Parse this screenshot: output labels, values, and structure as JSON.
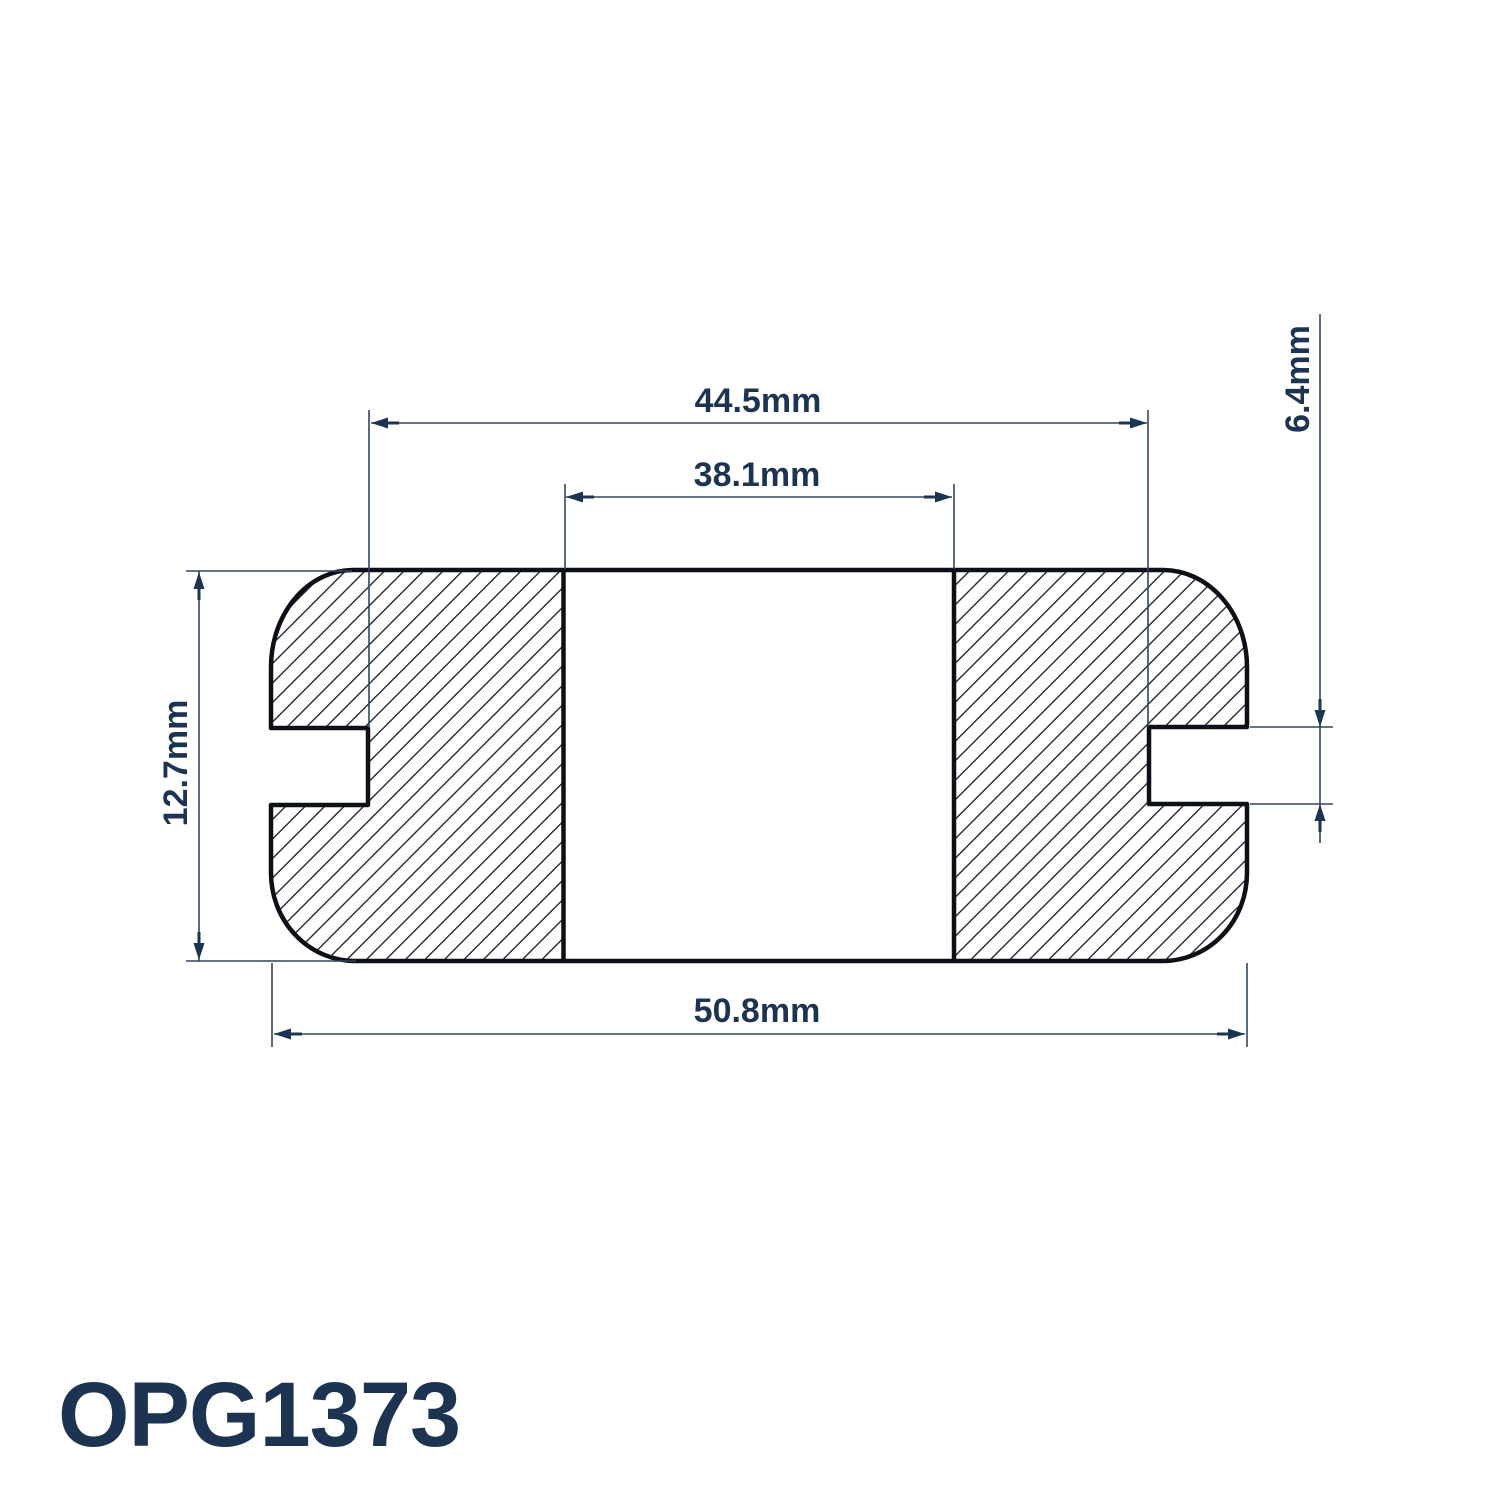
{
  "drawing": {
    "part_number": "OPG1373",
    "dimensions": {
      "flange_width": "44.5mm",
      "bore_width": "38.1mm",
      "height": "12.7mm",
      "overall_width": "50.8mm",
      "groove_height": "6.4mm"
    }
  },
  "colors": {
    "text": "#1c3452",
    "dim_line": "#31465e",
    "outline": "#0d1117",
    "hatch": "#232a33",
    "background": "#ffffff"
  }
}
